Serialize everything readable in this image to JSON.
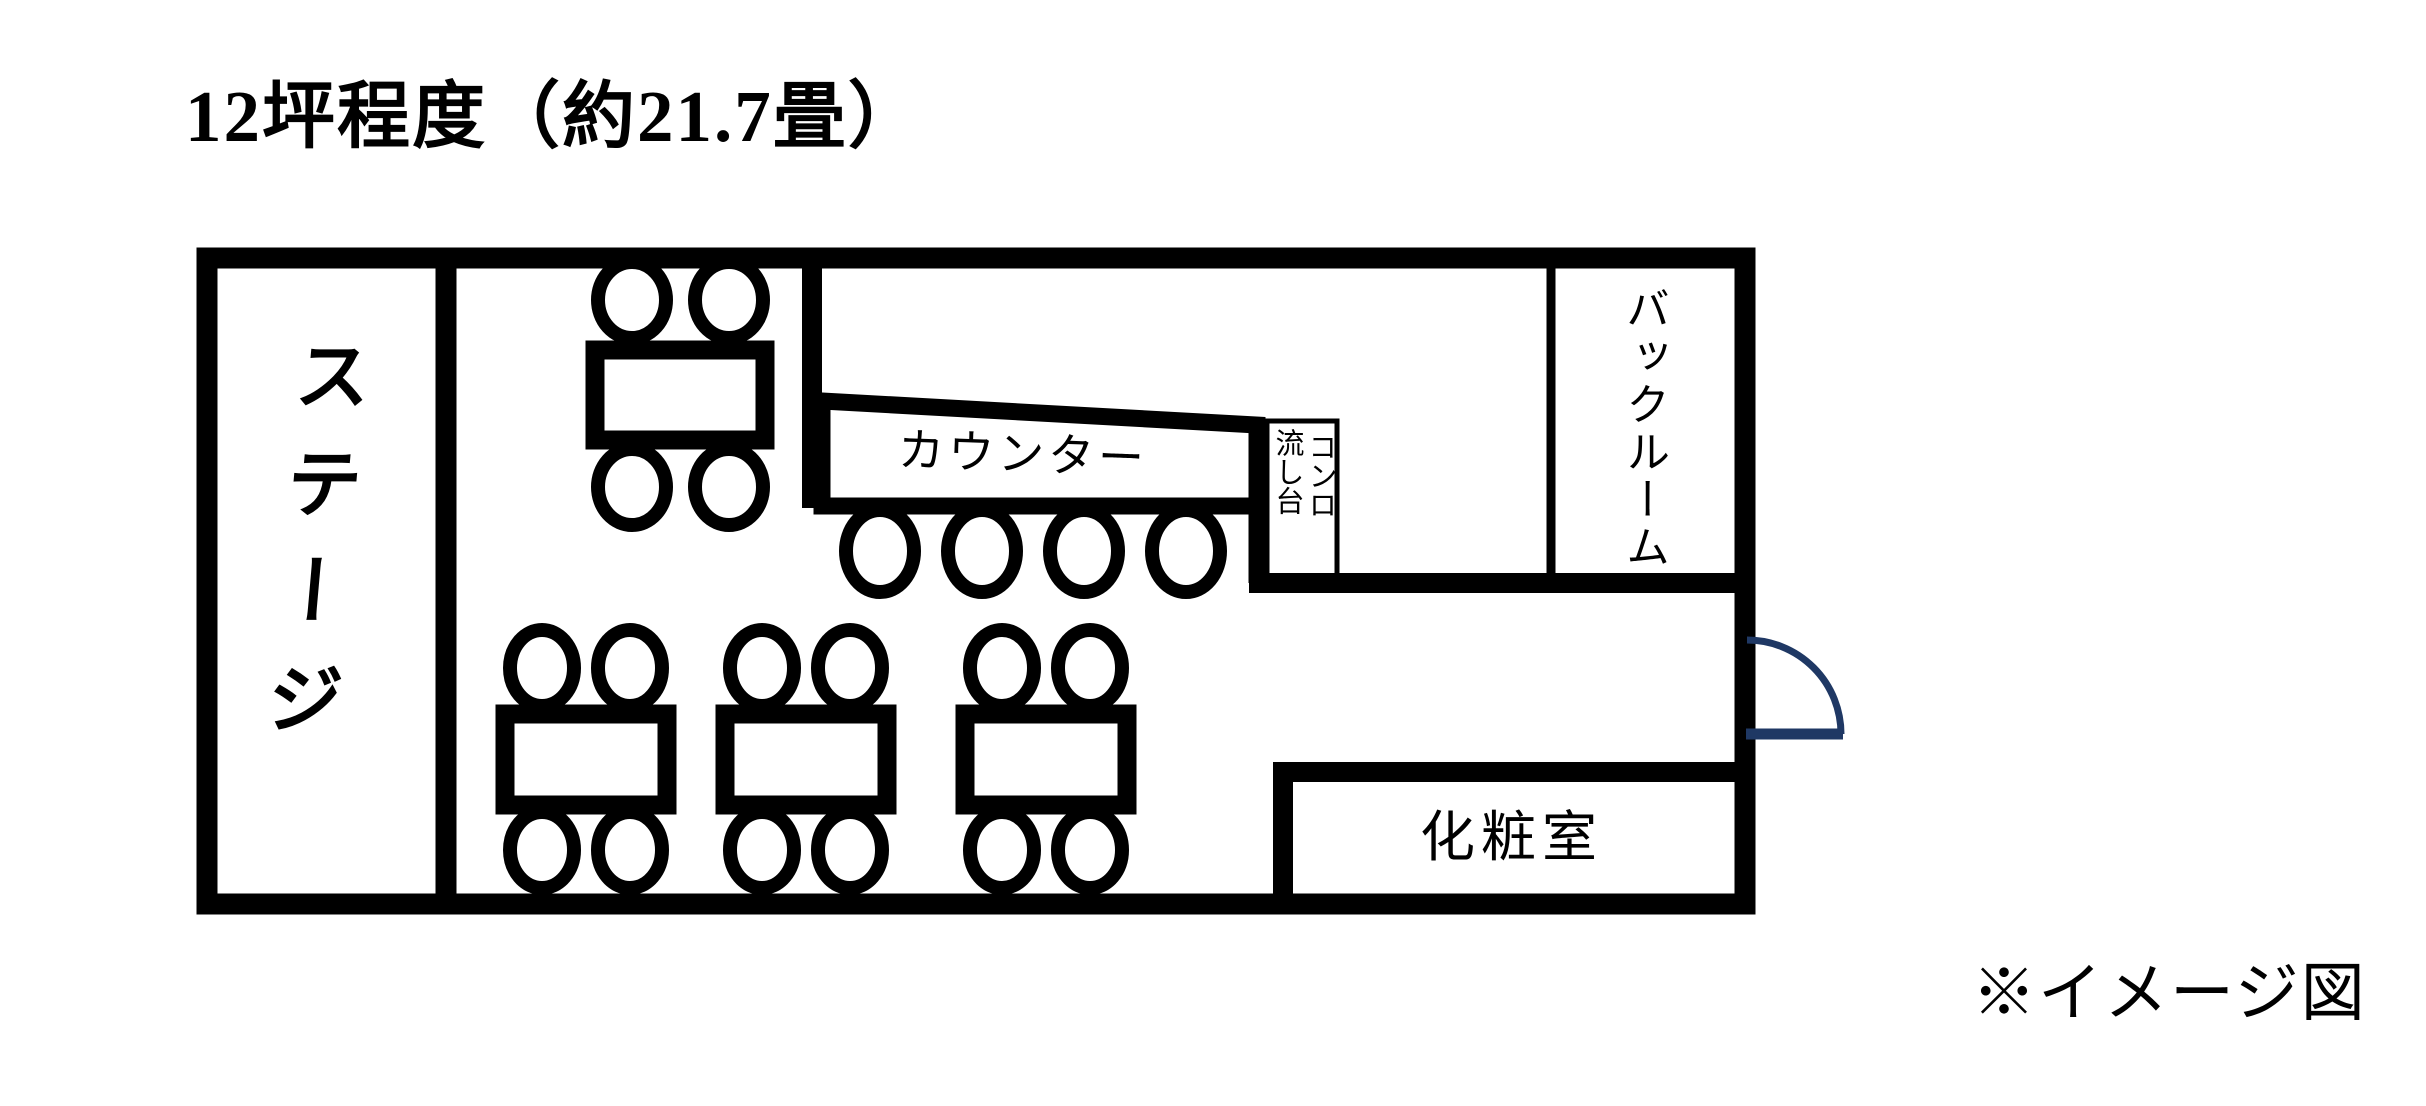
{
  "title": "12坪程度（約21.7畳）",
  "footnote": "※イメージ図",
  "rooms": {
    "stage": {
      "label": "ステージ"
    },
    "counter": {
      "label": "カウンター"
    },
    "stove_sink": {
      "right_column": "コンロ",
      "left_column": "流し台"
    },
    "backroom": {
      "label": "バックルーム"
    },
    "restroom": {
      "label": "化粧室"
    }
  },
  "furniture": {
    "dining_tables": 4,
    "seats_per_dining_table": 4,
    "counter_seats": 4
  },
  "colors": {
    "wall": "#000000",
    "door": "#1f3864",
    "background": "#ffffff",
    "text": "#000000"
  }
}
